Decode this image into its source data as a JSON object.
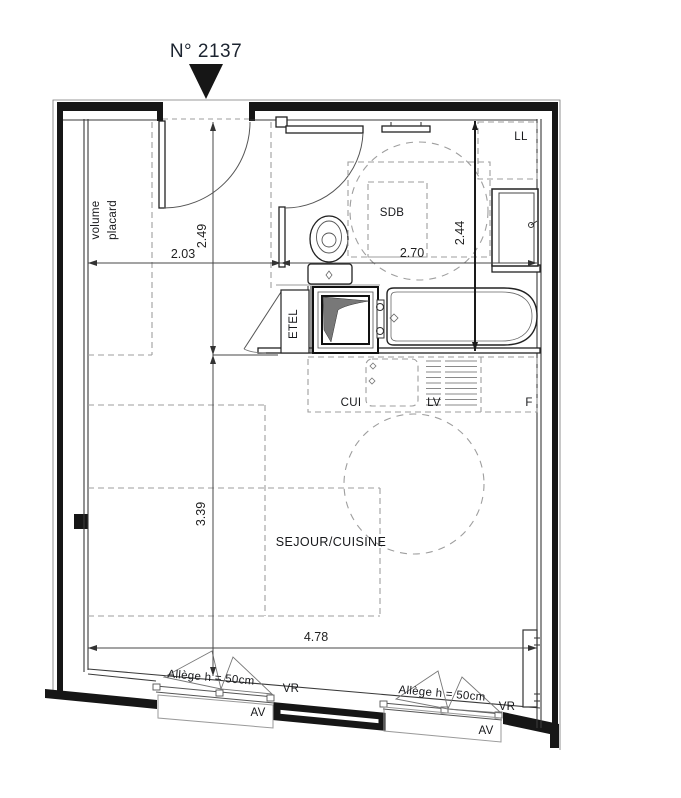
{
  "title": "N° 2137",
  "rooms": {
    "placard_line1": "volume",
    "placard_line2": "placard",
    "bathroom": "SDB",
    "living": "SEJOUR/CUISINE",
    "electrical_closet": "ETEL"
  },
  "appliances": {
    "washing_machine": "LL",
    "kitchen_counter": "CUI",
    "dishwasher": "LV",
    "fridge": "F"
  },
  "dimensions": {
    "entry_width": "2.03",
    "entry_depth": "2.49",
    "bath_width": "2.70",
    "bath_depth": "2.44",
    "living_depth": "3.39",
    "living_width": "4.78"
  },
  "windows": {
    "sill_note_1": "Allège h = 50cm",
    "sill_note_2": "Allège h = 50cm",
    "shutter_1": "VR",
    "shutter_2": "VR",
    "awning_1": "AV",
    "awning_2": "AV"
  },
  "colors": {
    "wall": "#161616",
    "thin_line": "#3a3a3a",
    "dashed_line": "#9e9e9e",
    "text": "#17181b",
    "title": "#1c2430",
    "duct_fill": "#787878"
  }
}
